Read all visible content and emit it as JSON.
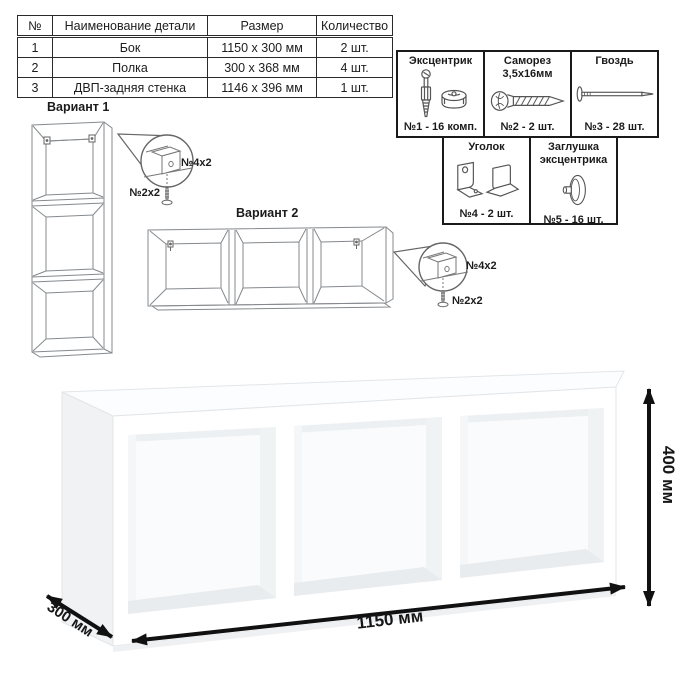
{
  "parts_table": {
    "headers": [
      "№",
      "Наименование детали",
      "Размер",
      "Количество"
    ],
    "rows": [
      {
        "num": "1",
        "name": "Бок",
        "size": "1150 x 300 мм",
        "qty": "2 шт."
      },
      {
        "num": "2",
        "name": "Полка",
        "size": "300 x 368 мм",
        "qty": "4 шт."
      },
      {
        "num": "3",
        "name": "ДВП-задняя стенка",
        "size": "1146 x 396 мм",
        "qty": "1 шт."
      }
    ]
  },
  "hardware_box": {
    "items": [
      {
        "title1": "Эксцентрик",
        "title2": "",
        "label": "№1 - 16 комп.",
        "icon": "cam-bolt-icon"
      },
      {
        "title1": "Саморез",
        "title2": "3,5x16мм",
        "label": "№2 - 2 шт.",
        "icon": "screw-icon"
      },
      {
        "title1": "Гвоздь",
        "title2": "",
        "label": "№3 - 28 шт.",
        "icon": "nail-icon"
      },
      {
        "title1": "Уголок",
        "title2": "",
        "label": "№4 - 2 шт.",
        "icon": "corner-bracket-icon"
      },
      {
        "title1": "Заглушка",
        "title2": "эксцентрика",
        "label": "№5 - 16 шт.",
        "icon": "cam-cover-icon"
      }
    ]
  },
  "variants": {
    "v1": {
      "title": "Вариант 1",
      "callout_bracket": "№4x2",
      "callout_screw": "№2x2"
    },
    "v2": {
      "title": "Вариант 2",
      "callout_bracket": "№4x2",
      "callout_screw": "№2x2"
    }
  },
  "dimensions": {
    "width": "1150 мм",
    "height": "400 мм",
    "depth": "300 мм"
  },
  "colors": {
    "line_art": "#85898d",
    "text": "#1b1b1b",
    "table_border": "#2a2a2a",
    "shelf_side": "#f0f2f4",
    "shelf_floor": "#e9ecee",
    "arrow": "#111111"
  }
}
